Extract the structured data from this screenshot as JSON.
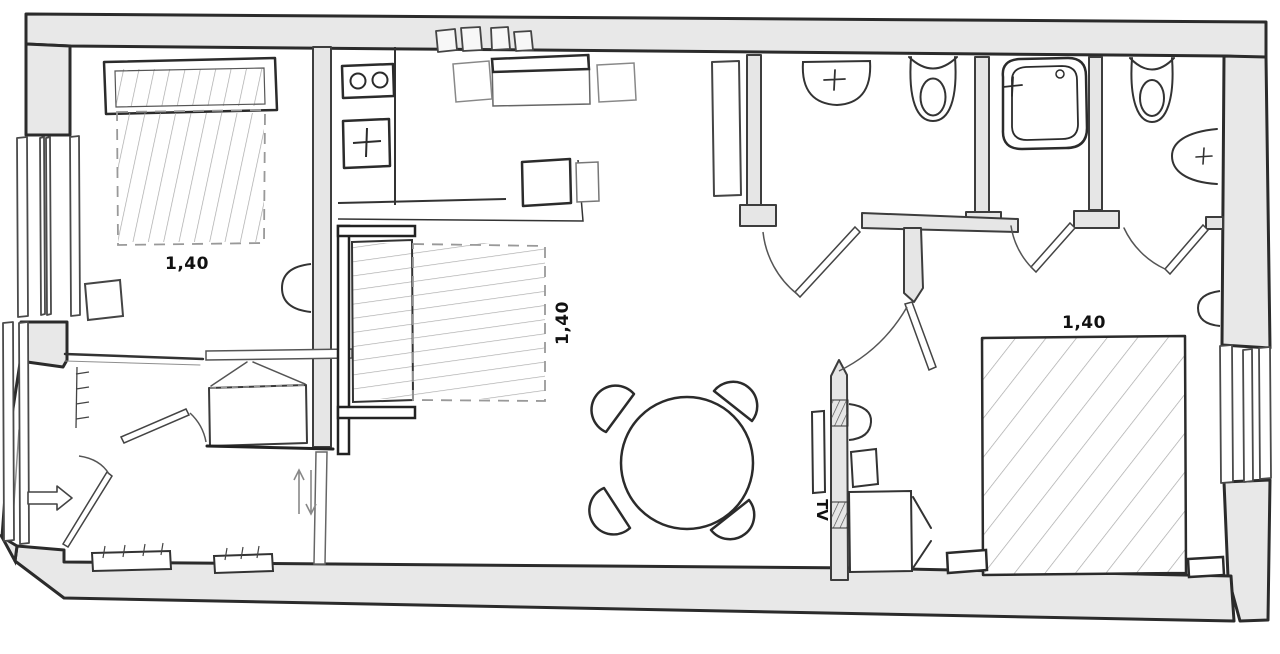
{
  "plan": {
    "labels": {
      "bedroom1_bed_width": "1,40",
      "sofa_bed_width": "1,40",
      "bedroom2_bed_width": "1,40",
      "tv": "TV"
    },
    "colors": {
      "background": "#ffffff",
      "outer_wall_fill": "#e8e8e8",
      "partition_fill": "#e6e6e6",
      "main_line": "#2b2b2b",
      "light_line": "#8f8f8f",
      "hatch_line": "#a8a8a8"
    },
    "fixtures": [
      "double-bed",
      "sofa-bed",
      "wardrobe",
      "nightstand",
      "side-table",
      "stove",
      "kitchen-sink",
      "kitchen-counter",
      "desk",
      "chair",
      "dining-table",
      "dining-chair",
      "tv",
      "sliding-door",
      "swing-door",
      "entrance-arrow",
      "washbasin",
      "toilet",
      "shower",
      "radiator",
      "window",
      "wall-lamp",
      "tall-cabinet"
    ]
  }
}
